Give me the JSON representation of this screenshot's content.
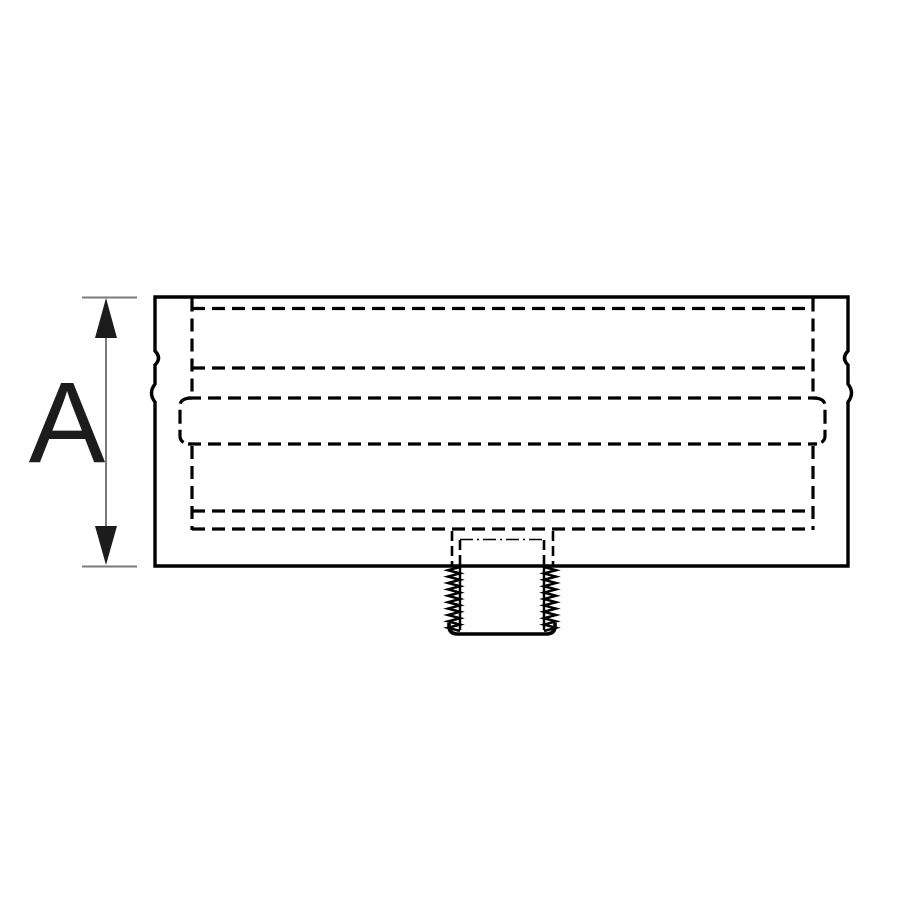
{
  "figure": {
    "type": "technical-line-drawing",
    "description_label": "",
    "dimension_label": "A",
    "colors": {
      "background": "#ffffff",
      "line": "#000000",
      "dimension_line": "#7a7a7a",
      "label": "#1c1c1c"
    }
  }
}
